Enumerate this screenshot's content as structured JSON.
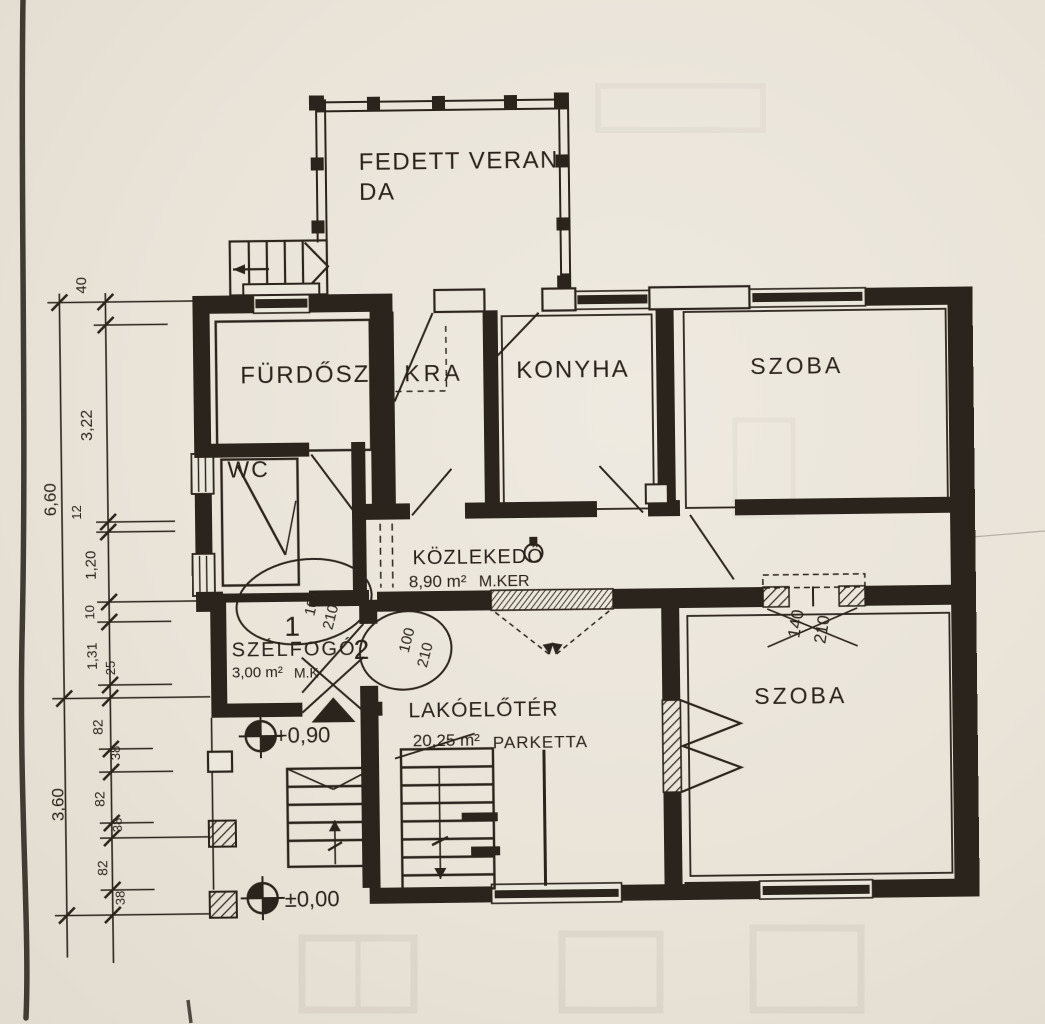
{
  "veranda": {
    "label_line1": "FEDETT VERAN-",
    "label_line2": "DA"
  },
  "rooms": {
    "bathroom": "FÜRDŐSZ.",
    "wc": "WC",
    "pantry": "KRA",
    "kitchen": "KONYHA",
    "room_top": "SZOBA",
    "room_bottom": "SZOBA",
    "hall": {
      "name": "KÖZLEKEDŐ",
      "area": "8,90 m²",
      "finish": "M.KER"
    },
    "windbreak": {
      "name": "SZÉLFOGÓ",
      "area": "3,00 m²",
      "finish": "M.K"
    },
    "foyer": {
      "name": "LAKÓELŐTÉR",
      "area": "20,25 m²",
      "finish": "PARKETTA"
    }
  },
  "doors": {
    "d1": {
      "no": "1",
      "w": "100",
      "h": "210"
    },
    "d2": {
      "no": "2",
      "w": "100",
      "h": "210"
    },
    "d3": {
      "w": "140",
      "h": "210"
    }
  },
  "levels": {
    "terrace": "+0,90",
    "ground": "±0,00"
  },
  "dimensions": {
    "outer": [
      "6,60",
      "3,60"
    ],
    "inner": [
      "40",
      "3,22",
      "12",
      "1,20",
      "10",
      "1,31",
      "25",
      "82",
      "38",
      "82",
      "38",
      "82",
      "38"
    ]
  },
  "colors": {
    "ink": "#2a241c",
    "paper": "#e9e3d8"
  }
}
